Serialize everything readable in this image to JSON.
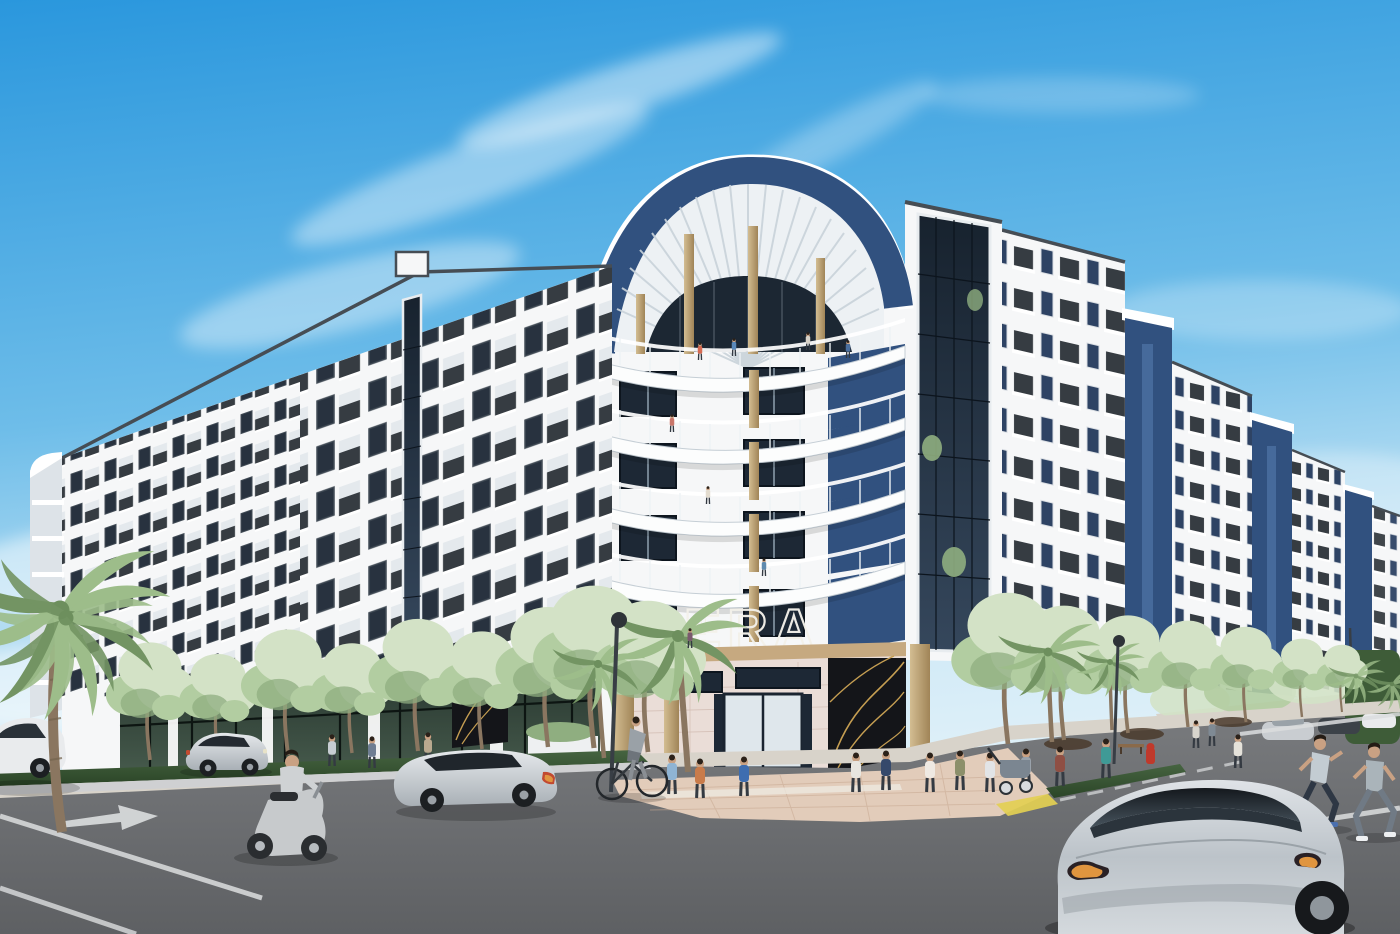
{
  "scene": {
    "type": "architectural rendering",
    "setting": "sunny day street corner",
    "description": "Seven-story white and navy ERA apartment building with curved corner balconies, rooftop pergola crown, gold columns, street-level retail, palm trees, street trees, pedestrians, cyclist, scooter rider, joggers and cars at an intersection"
  },
  "building": {
    "sign_prefix": "THE",
    "sign_text": "ERA",
    "floors": 7,
    "features": [
      "curved corner balcony tower",
      "rooftop pergola arch",
      "navy accent panels",
      "gold entry columns",
      "black-and-gold art murals",
      "glass stair curtain wall",
      "ground floor retail"
    ]
  },
  "street": {
    "vehicles": [
      "white parked sedan",
      "silver sedan",
      "gray wagon sedan",
      "vespa scooter with rider",
      "bicycle with rider",
      "silver electric fastback",
      "distant parked cars"
    ],
    "people": [
      "plaza pedestrians",
      "woman with stroller",
      "two joggers crossing",
      "balcony residents",
      "rooftop terrace guests"
    ],
    "markings": [
      "turn arrow",
      "lane lines",
      "crosswalk lines",
      "tactile curb ramp"
    ]
  },
  "colors": {
    "sky_top": "#2a97dd",
    "sky_mid": "#6ebde9",
    "sky_low": "#cfe9f6",
    "cloud": "#ffffff",
    "facade": "#f6f7f8",
    "facade_shadow": "#dde3e8",
    "coping": "#464d54",
    "navy": "#31517f",
    "navy_dark": "#27406a",
    "glass": "#1d2835",
    "glass_frame": "#0e161f",
    "glass_blue": "#3c5a80",
    "slat_gap": "#c9d3da",
    "gold_light": "#d3bd92",
    "gold_dark": "#a08457",
    "tree_light": "#d3e2c6",
    "tree_mid": "#b2cda1",
    "tree_dark": "#8fae80",
    "palm": "#9dbd8a",
    "palm_dark": "#739463",
    "hedge": "#3e5c38",
    "grass": "#3a5632",
    "mulch": "#4a3a2c",
    "road": "#7a7c7f",
    "road_dark": "#5e6063",
    "sidewalk": "#d8d3ca",
    "paver": "#e2ccba",
    "curb": "#cfd0d2",
    "marking": "#dcdedf",
    "ramp_yellow": "#e3cf52",
    "store_glass": "#2b3a31",
    "tile": "#eaddd7",
    "wood": "#c6a980",
    "mural": "#141519",
    "mural_gold": "#c59e52",
    "car_silver": "#c9cdd1",
    "car_white": "#e9ebed",
    "car_glass": "#20262c",
    "taillight": "#c24a30",
    "amber": "#e0953f",
    "skin": "#c9a183",
    "pants_dark": "#343a42",
    "hydrant": "#c0392b",
    "pole": "#383e45",
    "trunk": "#8a7660"
  }
}
